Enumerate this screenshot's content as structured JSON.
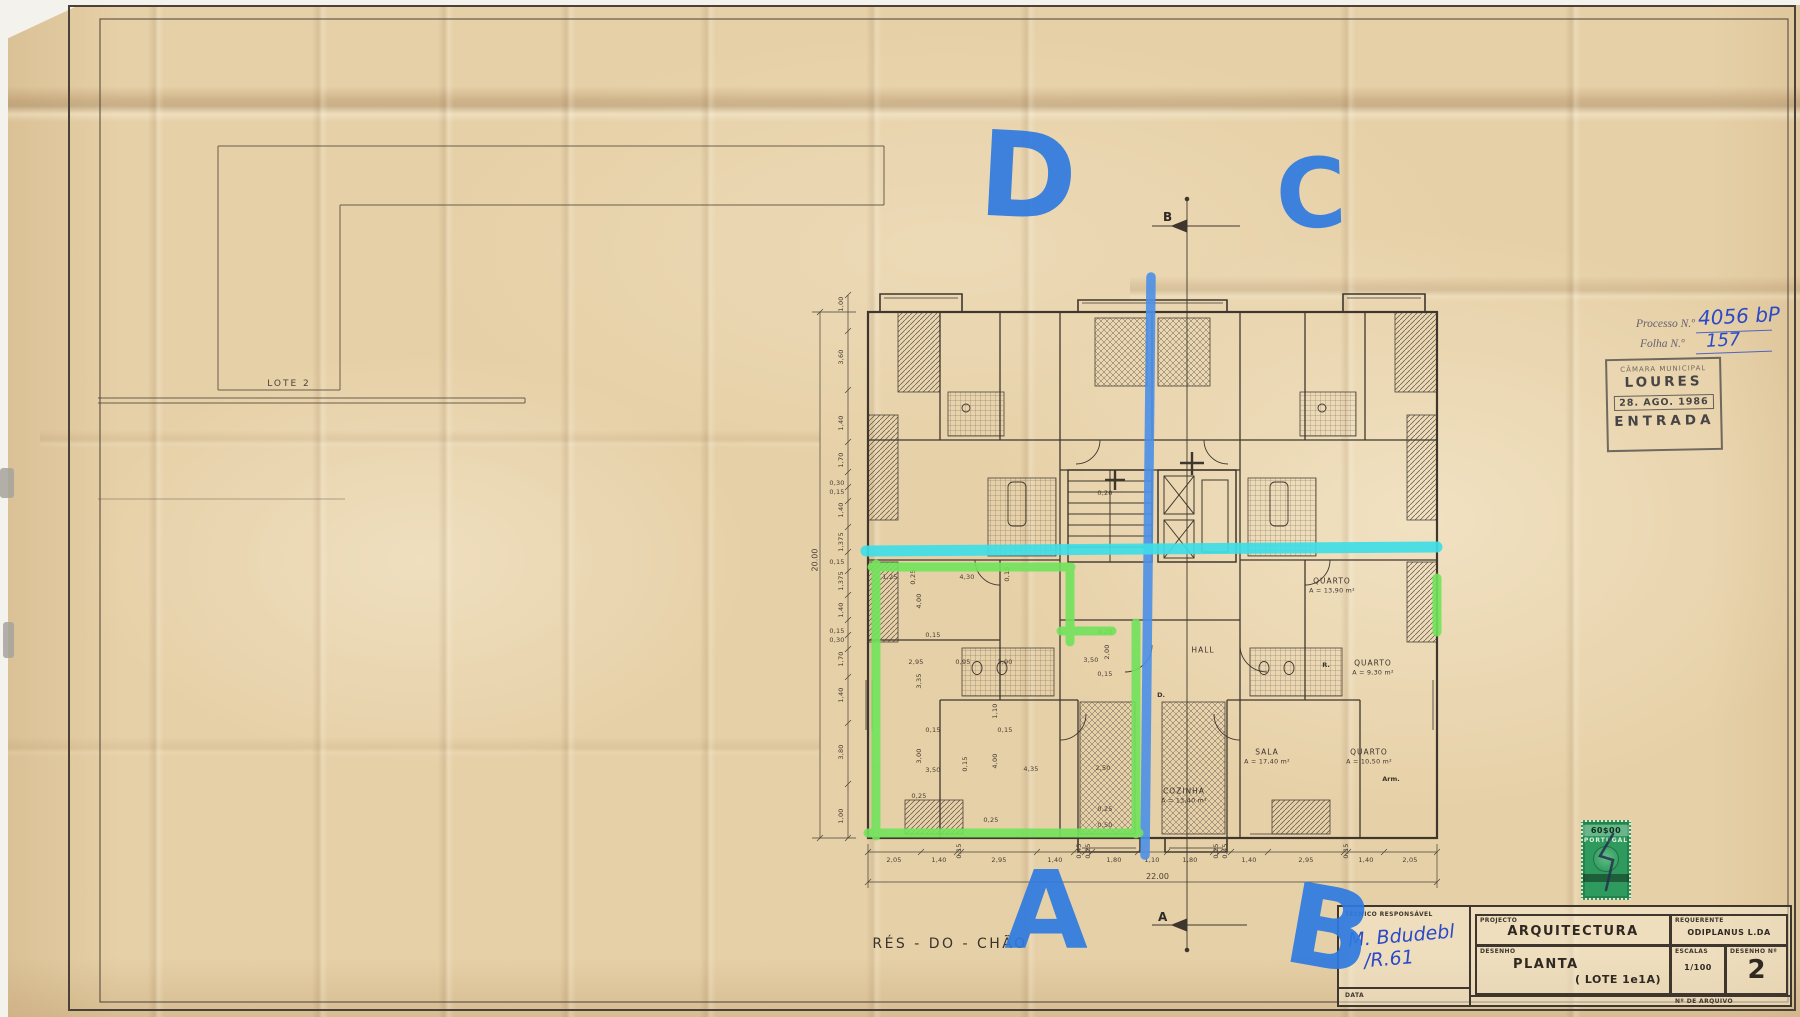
{
  "sheet": {
    "drawing_label": "RÉS - DO - CHÃO",
    "lot_label": "LOTE  2"
  },
  "plan": {
    "section_top": "B",
    "section_bottom": "A",
    "total_bottom": "22.00",
    "total_left": "20.00",
    "rooms": [
      {
        "name": "QUARTO",
        "area": "A = 13,90 m²",
        "x": 1332,
        "y": 586
      },
      {
        "name": "QUARTO",
        "area": "A = 9,30 m²",
        "x": 1373,
        "y": 668
      },
      {
        "name": "SALA",
        "area": "A = 17,40 m²",
        "x": 1267,
        "y": 757
      },
      {
        "name": "QUARTO",
        "area": "A = 10,50 m²",
        "x": 1369,
        "y": 757
      },
      {
        "name": "COZINHA",
        "area": "A = 13,40 m²",
        "x": 1184,
        "y": 796
      },
      {
        "name": "HALL",
        "area": "",
        "x": 1203,
        "y": 650
      }
    ],
    "tags": [
      {
        "t": "D.",
        "x": 1161,
        "y": 695
      },
      {
        "t": "R.",
        "x": 1326,
        "y": 665
      },
      {
        "t": "Arm.",
        "x": 1391,
        "y": 779
      }
    ],
    "dims_bottom": [
      {
        "t": "2,05",
        "x": 894,
        "y": 860
      },
      {
        "t": "1,40",
        "x": 939,
        "y": 860
      },
      {
        "t": "0,15",
        "x": 959,
        "y": 851,
        "r": -90
      },
      {
        "t": "2,95",
        "x": 999,
        "y": 860
      },
      {
        "t": "1,40",
        "x": 1055,
        "y": 860
      },
      {
        "t": "0,45",
        "x": 1079,
        "y": 851,
        "r": -90
      },
      {
        "t": "0,25",
        "x": 1088,
        "y": 851,
        "r": -90
      },
      {
        "t": "1,80",
        "x": 1114,
        "y": 860
      },
      {
        "t": "1,10",
        "x": 1152,
        "y": 860
      },
      {
        "t": "1,80",
        "x": 1190,
        "y": 860
      },
      {
        "t": "0,25",
        "x": 1216,
        "y": 851,
        "r": -90
      },
      {
        "t": "0,45",
        "x": 1225,
        "y": 851,
        "r": -90
      },
      {
        "t": "1,40",
        "x": 1249,
        "y": 860
      },
      {
        "t": "2,95",
        "x": 1306,
        "y": 860
      },
      {
        "t": "0,15",
        "x": 1346,
        "y": 851,
        "r": -90
      },
      {
        "t": "1,40",
        "x": 1366,
        "y": 860
      },
      {
        "t": "2,05",
        "x": 1410,
        "y": 860
      }
    ],
    "dims_left": [
      {
        "t": "1,00",
        "x": 841,
        "y": 304,
        "r": -90
      },
      {
        "t": "3,60",
        "x": 841,
        "y": 357,
        "r": -90
      },
      {
        "t": "1,40",
        "x": 841,
        "y": 423,
        "r": -90
      },
      {
        "t": "1,70",
        "x": 841,
        "y": 460,
        "r": -90
      },
      {
        "t": "0,30",
        "x": 837,
        "y": 483
      },
      {
        "t": "0,15",
        "x": 837,
        "y": 492
      },
      {
        "t": "1,40",
        "x": 841,
        "y": 510,
        "r": -90
      },
      {
        "t": "1,375",
        "x": 841,
        "y": 542,
        "r": -90
      },
      {
        "t": "0,15",
        "x": 837,
        "y": 562
      },
      {
        "t": "1,375",
        "x": 841,
        "y": 581,
        "r": -90
      },
      {
        "t": "1,40",
        "x": 841,
        "y": 610,
        "r": -90
      },
      {
        "t": "0,15",
        "x": 837,
        "y": 631
      },
      {
        "t": "0,30",
        "x": 837,
        "y": 640
      },
      {
        "t": "1,70",
        "x": 841,
        "y": 659,
        "r": -90
      },
      {
        "t": "1,40",
        "x": 841,
        "y": 695,
        "r": -90
      },
      {
        "t": "3,80",
        "x": 841,
        "y": 752,
        "r": -90
      },
      {
        "t": "1,00",
        "x": 841,
        "y": 816,
        "r": -90
      }
    ],
    "dims_interior": [
      {
        "t": "1,25",
        "x": 890,
        "y": 577
      },
      {
        "t": "0,25",
        "x": 913,
        "y": 577,
        "r": -90
      },
      {
        "t": "4,30",
        "x": 967,
        "y": 577
      },
      {
        "t": "0,15",
        "x": 1007,
        "y": 574,
        "r": -90
      },
      {
        "t": "4,00",
        "x": 919,
        "y": 601,
        "r": -90
      },
      {
        "t": "0,20",
        "x": 1105,
        "y": 493
      },
      {
        "t": "0,15",
        "x": 933,
        "y": 635
      },
      {
        "t": "2,95",
        "x": 916,
        "y": 662
      },
      {
        "t": "0,95",
        "x": 963,
        "y": 662
      },
      {
        "t": "3,90",
        "x": 1005,
        "y": 662
      },
      {
        "t": "3,50",
        "x": 1091,
        "y": 660
      },
      {
        "t": "0,20",
        "x": 1105,
        "y": 632
      },
      {
        "t": "2,00",
        "x": 1107,
        "y": 652,
        "r": -90
      },
      {
        "t": "0,15",
        "x": 1105,
        "y": 674
      },
      {
        "t": "3,35",
        "x": 919,
        "y": 681,
        "r": -90
      },
      {
        "t": "1,10",
        "x": 995,
        "y": 711,
        "r": -90
      },
      {
        "t": "0,15",
        "x": 1005,
        "y": 730
      },
      {
        "t": "0,15",
        "x": 933,
        "y": 730
      },
      {
        "t": "3,00",
        "x": 919,
        "y": 756,
        "r": -90
      },
      {
        "t": "3,50",
        "x": 933,
        "y": 770
      },
      {
        "t": "4,00",
        "x": 995,
        "y": 761,
        "r": -90
      },
      {
        "t": "0,15",
        "x": 965,
        "y": 764,
        "r": -90
      },
      {
        "t": "4,35",
        "x": 1031,
        "y": 769
      },
      {
        "t": "2,50",
        "x": 1103,
        "y": 768
      },
      {
        "t": "0,25",
        "x": 919,
        "y": 796
      },
      {
        "t": "0,25",
        "x": 991,
        "y": 820
      },
      {
        "t": "0,25",
        "x": 1105,
        "y": 809
      },
      {
        "t": "0,50",
        "x": 1105,
        "y": 825
      }
    ]
  },
  "annotations": {
    "marker_color": "#2e7ae0",
    "highlight_cyan": "#3edde6",
    "highlight_green": "#70e35a",
    "letters": [
      {
        "t": "D",
        "x": 1028,
        "y": 176,
        "fs": 118,
        "r": 3
      },
      {
        "t": "C",
        "x": 1311,
        "y": 194,
        "fs": 96,
        "r": -2
      },
      {
        "t": "A",
        "x": 1046,
        "y": 912,
        "fs": 108,
        "r": 0
      },
      {
        "t": "B",
        "x": 1329,
        "y": 930,
        "fs": 112,
        "r": 10
      }
    ],
    "signature_line1": "M. Bdudebl",
    "signature_line2": "/R.61"
  },
  "stamps": {
    "processo": {
      "label": "Processo N.º",
      "value": "4056 bP"
    },
    "folha": {
      "label": "Folha N.º",
      "value": "157"
    },
    "entrada": {
      "line1": "CÂMARA MUNICIPAL",
      "line2": "LOURES",
      "date": "28. AGO. 1986",
      "line4": "ENTRADA"
    },
    "tax": {
      "value": "60$00",
      "country": "PORTUGAL"
    }
  },
  "title_block": {
    "tecnico_label": "TÉCNICO RESPONSÁVEL",
    "data_label": "DATA",
    "projecto_label": "PROJECTO",
    "projecto_value": "ARQUITECTURA",
    "requerente_label": "REQUERENTE",
    "requerente_value": "ODIPLANUS  L.DA",
    "desenho_label": "DESENHO",
    "desenho_value": "PLANTA",
    "desenho_sub": "( LOTE  1e1A)",
    "escalas_label": "ESCALAS",
    "escalas_value": "1/100",
    "numero_label": "DESENHO Nº",
    "numero_value": "2",
    "arquivo_label": "Nº DE ARQUIVO"
  }
}
